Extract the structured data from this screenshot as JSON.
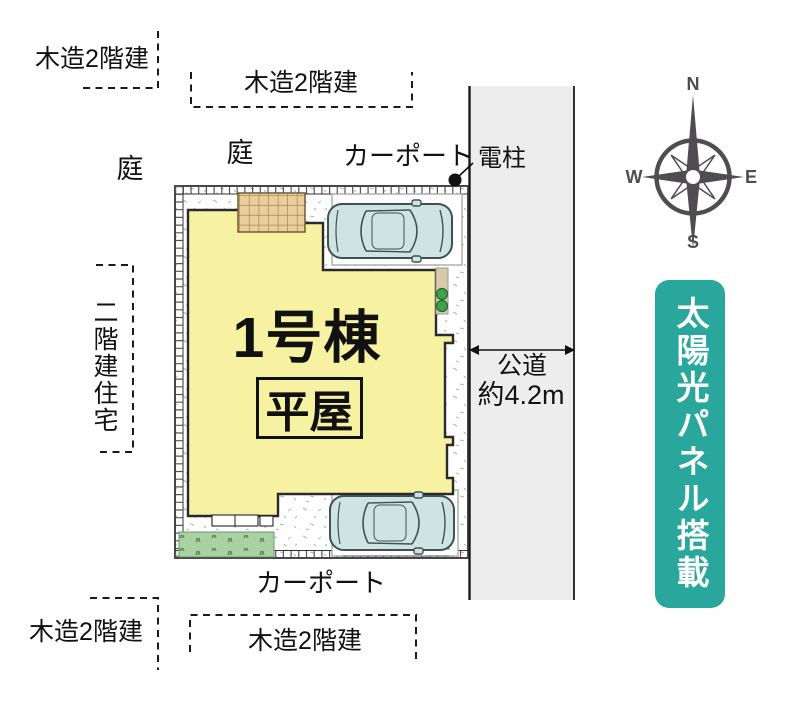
{
  "plan": {
    "building": {
      "name": "1号棟",
      "type": "平屋"
    },
    "labels": {
      "neighbor_top_left": "木造2階建",
      "neighbor_top_center": "木造2階建",
      "neighbor_left": "二階建住宅",
      "neighbor_bottom_left": "木造2階建",
      "neighbor_bottom_center": "木造2階建",
      "garden_left": "庭",
      "garden_center": "庭",
      "carport_top": "カーポート",
      "carport_bottom": "カーポート",
      "utility_pole": "電柱"
    },
    "road": {
      "name": "公道",
      "width": "約4.2m"
    },
    "badge": {
      "solar": "太陽光パネル搭載"
    },
    "compass": {
      "n": "N",
      "e": "E",
      "s": "S",
      "w": "W"
    },
    "colors": {
      "building_fill": "#f6f2a2",
      "road_fill": "#ededed",
      "badge_teal": "#2aa79d",
      "car_fill": "#cfe4e2",
      "deck_fill": "#eace9e",
      "grass_fill": "#aad1a2",
      "compass_gray": "#4f4d52"
    }
  }
}
